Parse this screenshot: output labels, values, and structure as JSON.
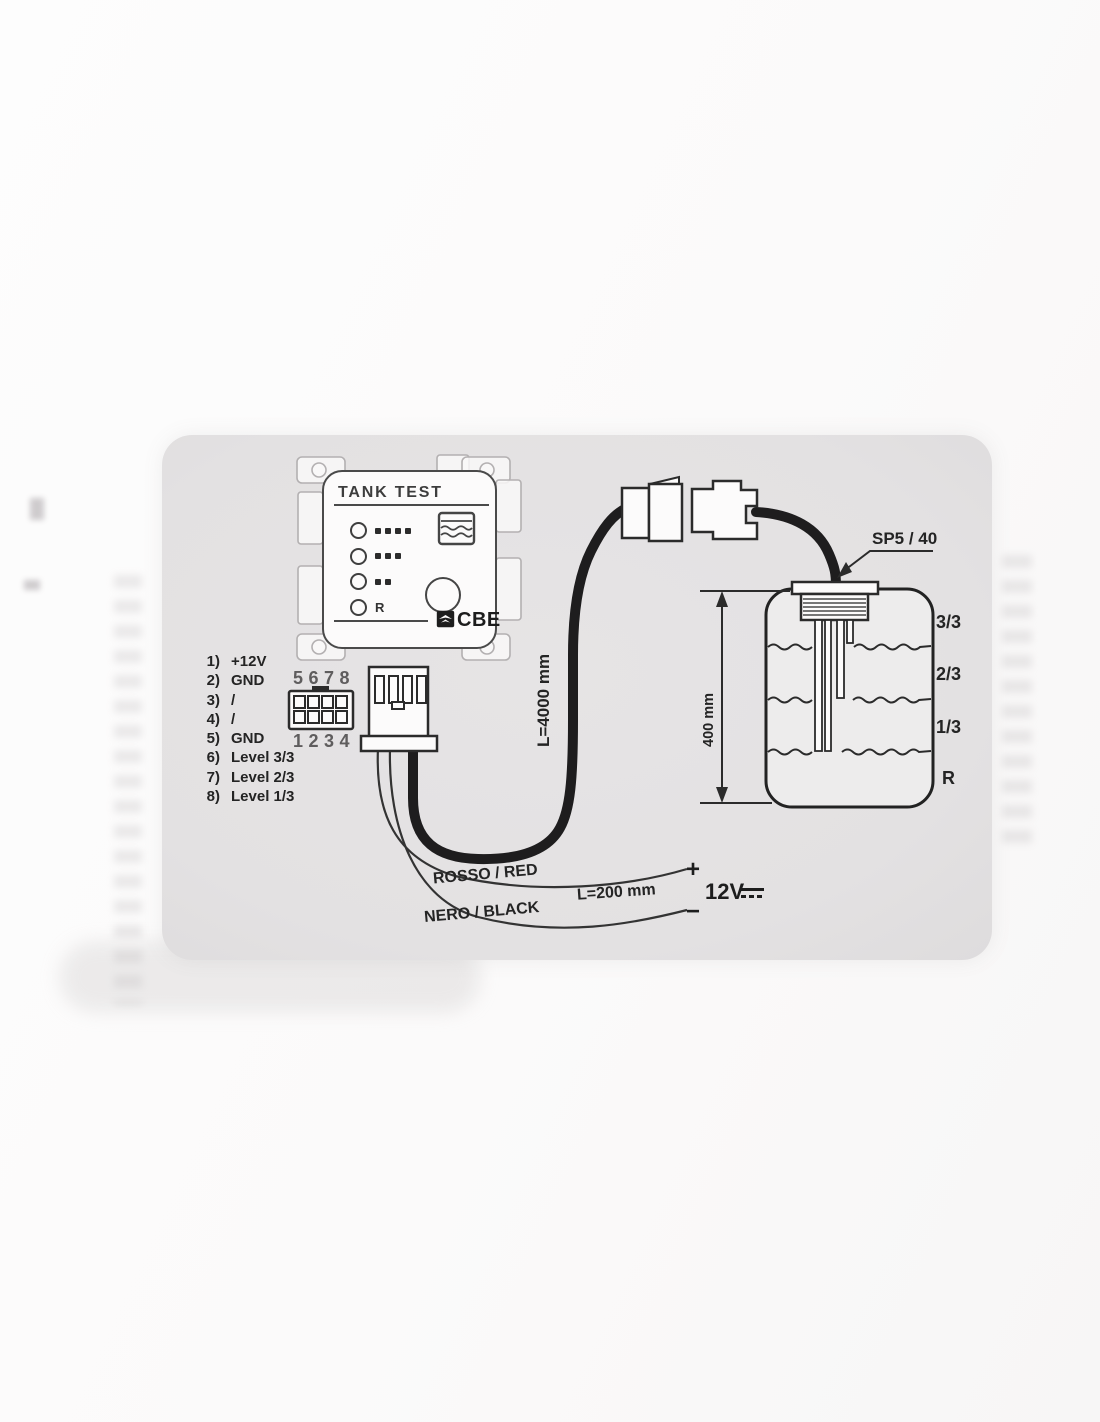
{
  "diagram": {
    "panel": {
      "title": "TANK TEST",
      "brand": "CBE",
      "led_rows": [
        {
          "dots": 4,
          "label": ""
        },
        {
          "dots": 3,
          "label": ""
        },
        {
          "dots": 2,
          "label": ""
        },
        {
          "dots": 0,
          "label": "R"
        }
      ]
    },
    "pin_list": [
      {
        "num": "1)",
        "label": "+12V"
      },
      {
        "num": "2)",
        "label": "GND"
      },
      {
        "num": "3)",
        "label": "/"
      },
      {
        "num": "4)",
        "label": "/"
      },
      {
        "num": "5)",
        "label": "GND"
      },
      {
        "num": "6)",
        "label": "Level 3/3"
      },
      {
        "num": "7)",
        "label": "Level 2/3"
      },
      {
        "num": "8)",
        "label": "Level 1/3"
      }
    ],
    "connector_front": {
      "top_row": "5678",
      "bottom_row": "1234"
    },
    "cable": {
      "length": "L=4000 mm"
    },
    "probe": {
      "model": "SP5 / 40"
    },
    "tank": {
      "height_dimension": "400 mm",
      "level_labels": [
        "3/3",
        "2/3",
        "1/3",
        "R"
      ]
    },
    "power": {
      "red_wire": "ROSSO / RED",
      "black_wire": "NERO / BLACK",
      "wire_length": "L=200 mm",
      "plus": "+",
      "minus": "−",
      "voltage": "12V"
    },
    "colors": {
      "line": "#2b2b2b",
      "cable": "#1e1d1e",
      "paper": "#fbfafa",
      "panel_gray": "#e4e2e3"
    }
  }
}
